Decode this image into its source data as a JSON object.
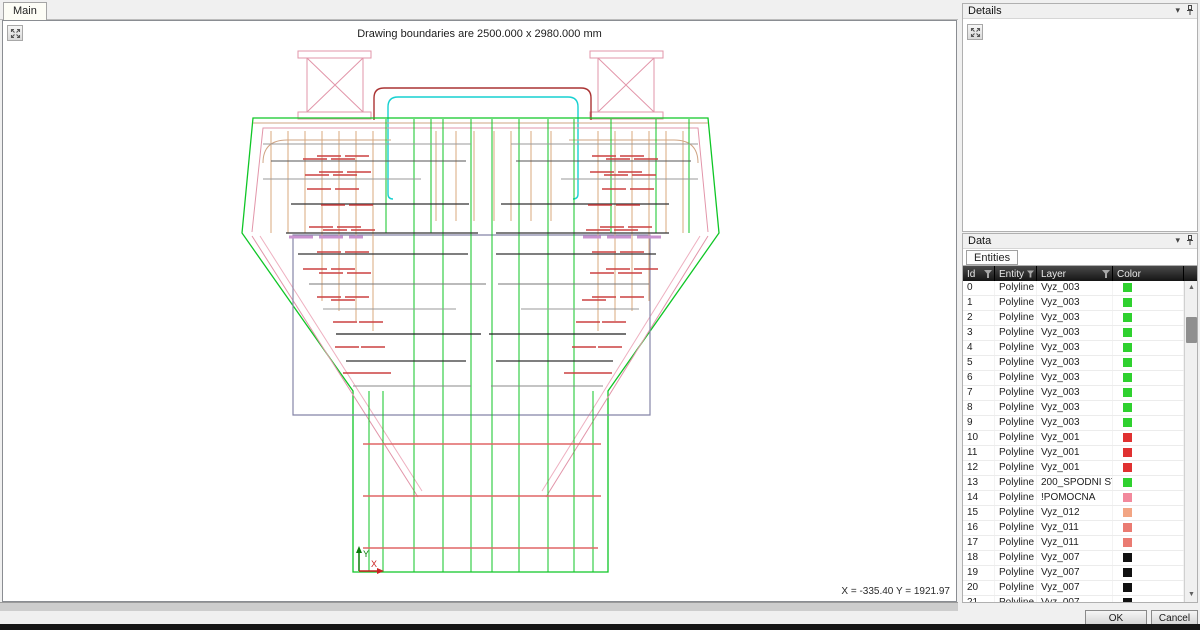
{
  "main_panel": {
    "tab": "Main",
    "canvas_title": "Drawing boundaries are 2500.000 x 2980.000 mm",
    "status_coords": "X = -335.40  Y = 1921.97"
  },
  "details_panel": {
    "title": "Details"
  },
  "data_panel": {
    "title": "Data",
    "tab": "Entities",
    "columns": [
      "Id",
      "Entity",
      "Layer",
      "Color"
    ],
    "rows": [
      {
        "id": "0",
        "entity": "Polyline 2D",
        "layer": "Vyz_003",
        "color": "#2fd12f"
      },
      {
        "id": "1",
        "entity": "Polyline 2D",
        "layer": "Vyz_003",
        "color": "#2fd12f"
      },
      {
        "id": "2",
        "entity": "Polyline 2D",
        "layer": "Vyz_003",
        "color": "#2fd12f"
      },
      {
        "id": "3",
        "entity": "Polyline 2D",
        "layer": "Vyz_003",
        "color": "#2fd12f"
      },
      {
        "id": "4",
        "entity": "Polyline 2D",
        "layer": "Vyz_003",
        "color": "#2fd12f"
      },
      {
        "id": "5",
        "entity": "Polyline 2D",
        "layer": "Vyz_003",
        "color": "#2fd12f"
      },
      {
        "id": "6",
        "entity": "Polyline 2D",
        "layer": "Vyz_003",
        "color": "#2fd12f"
      },
      {
        "id": "7",
        "entity": "Polyline 2D",
        "layer": "Vyz_003",
        "color": "#2fd12f"
      },
      {
        "id": "8",
        "entity": "Polyline 2D",
        "layer": "Vyz_003",
        "color": "#2fd12f"
      },
      {
        "id": "9",
        "entity": "Polyline 2D",
        "layer": "Vyz_003",
        "color": "#2fd12f"
      },
      {
        "id": "10",
        "entity": "Polyline 2D",
        "layer": "Vyz_001",
        "color": "#e03131"
      },
      {
        "id": "11",
        "entity": "Polyline 2D",
        "layer": "Vyz_001",
        "color": "#e03131"
      },
      {
        "id": "12",
        "entity": "Polyline 2D",
        "layer": "Vyz_001",
        "color": "#e03131"
      },
      {
        "id": "13",
        "entity": "Polyline 2D",
        "layer": "200_SPODNI STAVBA",
        "color": "#2fd12f"
      },
      {
        "id": "14",
        "entity": "Polyline 2D",
        "layer": "!POMOCNA",
        "color": "#f2899c"
      },
      {
        "id": "15",
        "entity": "Polyline 2D",
        "layer": "Vyz_012",
        "color": "#f2a584"
      },
      {
        "id": "16",
        "entity": "Polyline 2D",
        "layer": "Vyz_011",
        "color": "#ea7b72"
      },
      {
        "id": "17",
        "entity": "Polyline 2D",
        "layer": "Vyz_011",
        "color": "#ea7b72"
      },
      {
        "id": "18",
        "entity": "Polyline 2D",
        "layer": "Vyz_007",
        "color": "#111111"
      },
      {
        "id": "19",
        "entity": "Polyline 2D",
        "layer": "Vyz_007",
        "color": "#111111"
      },
      {
        "id": "20",
        "entity": "Polyline 2D",
        "layer": "Vyz_007",
        "color": "#111111"
      },
      {
        "id": "21",
        "entity": "Polyline 2D",
        "layer": "Vyz_007",
        "color": "#111111"
      }
    ]
  },
  "footer": {
    "ok_label": "OK",
    "cancel_label": "Cancel"
  },
  "drawing": {
    "tick_len": 24,
    "tick_color": "#cc4040",
    "paths": [
      {
        "d": "M297 50 H370 V57 H297 Z",
        "s": "#e295a9",
        "w": 1
      },
      {
        "d": "M306 57 H362 V111 H306 Z M306 57 L362 111 M362 57 L306 111",
        "s": "#e295a9",
        "w": 1
      },
      {
        "d": "M297 111 H370 V118 H297 Z",
        "s": "#e295a9",
        "w": 1
      },
      {
        "d": "M589 50 H662 V57 H589 Z",
        "s": "#e295a9",
        "w": 1
      },
      {
        "d": "M597 57 H653 V111 H597 Z M597 57 L653 111 M653 57 L597 111",
        "s": "#e295a9",
        "w": 1
      },
      {
        "d": "M589 111 H662 V118 H589 Z",
        "s": "#e295a9",
        "w": 1
      },
      {
        "d": "M373 119 V97 Q373 87 383 87 H580 Q590 87 590 97 V119",
        "s": "#aa3333",
        "w": 1.4
      },
      {
        "d": "M387 193 V106 Q387 96 397 96 H567 Q577 96 577 106 V193",
        "s": "#17d1d1",
        "w": 1.4
      },
      {
        "d": "M387 193 Q387 198 392 198 M577 193 Q577 198 572 198",
        "s": "#17d1d1",
        "w": 1.4
      },
      {
        "d": "M252 117 H707 L718 232 L607 390 V571 H352 V390 L241 232 Z",
        "s": "#0fc626",
        "w": 1.3
      },
      {
        "d": "M251 231 L262 127 H697 L707 231",
        "s": "#e295a9",
        "w": 1
      },
      {
        "d": "M262 127 H697",
        "s": "#e295a9",
        "w": 1
      },
      {
        "d": "M251 235 L417 496 M707 235 L545 496",
        "s": "#e295a9",
        "w": 1
      },
      {
        "d": "M259 235 L421 490 M699 235 L541 490",
        "s": "#eeb0c0",
        "w": 1
      },
      {
        "d": "M252 122 H707",
        "s": "#cfa483",
        "w": 1
      },
      {
        "d": "M262 162 Q262 139 286 139 H390 M697 162 Q697 139 673 139 H568",
        "s": "#cfa483",
        "w": 1
      },
      {
        "d": "M292 234 H649 V414 H292 Z",
        "s": "#8585a8",
        "w": 1.2
      },
      {
        "d": "M413 118 V571 M442 118 V571 M470 118 V571 M491 118 V571 M518 118 V571 M547 118 V571 M573 118 V571",
        "s": "#0fc626",
        "w": 1
      },
      {
        "d": "M385 118 V232 M430 118 V232 M610 118 V232 M655 118 V232 M688 118 V232",
        "s": "#0fc626",
        "w": 1
      },
      {
        "d": "M368 390 V571 M382 390 V571 M592 390 V571",
        "s": "#0fc626",
        "w": 1
      },
      {
        "d": "M270 130 V232 M287 130 V232 M304 130 V232 M321 130 V300 M338 130 V310 M355 130 V320 M372 130 V330",
        "s": "#d9a87e",
        "w": 1
      },
      {
        "d": "M597 130 V330 M614 130 V320 M631 130 V310 M648 130 V300 M665 130 V232 M682 130 V232",
        "s": "#d9a87e",
        "w": 1
      },
      {
        "d": "M435 130 V220 M455 130 V220 M473 130 V220 M493 130 V220 M510 130 V220 M530 130 V220 M550 130 V220",
        "s": "#d9a87e",
        "w": 1
      },
      {
        "d": "M262 143 H470 M510 143 H697",
        "s": "#999999",
        "w": 1
      },
      {
        "d": "M270 160 H465 M515 160 H690",
        "s": "#555555",
        "w": 1
      },
      {
        "d": "M262 178 H420 M560 178 H697",
        "s": "#999999",
        "w": 1
      },
      {
        "d": "M290 203 H468 M500 203 H668",
        "s": "#333333",
        "w": 1.2
      },
      {
        "d": "M285 232 H477 M495 232 H668",
        "s": "#333333",
        "w": 1.2
      },
      {
        "d": "M297 253 H467 M495 253 H655",
        "s": "#333333",
        "w": 1.2
      },
      {
        "d": "M308 283 H485 M497 283 H648",
        "s": "#777777",
        "w": 1
      },
      {
        "d": "M322 308 H455 M520 308 H638",
        "s": "#999999",
        "w": 1
      },
      {
        "d": "M335 333 H480 M488 333 H625",
        "s": "#222222",
        "w": 1.3
      },
      {
        "d": "M345 360 H465 M495 360 H612",
        "s": "#333333",
        "w": 1.2
      },
      {
        "d": "M352 385 H470 M490 385 H602",
        "s": "#888888",
        "w": 1
      },
      {
        "d": "M362 443 H600 M362 495 H600 M362 547 H597",
        "s": "#e06666",
        "w": 1.4
      },
      {
        "d": "M288 236 H312 M318 236 H342 M348 236 H362 M582 236 H600 M606 236 H630 M636 236 H660",
        "s": "#c993cf",
        "w": 3
      },
      {
        "d": "M358 570 V549",
        "s": "#0a7a0a",
        "w": 1.5
      },
      {
        "d": "M355 552 L358 545 L361 552 Z",
        "s": "none",
        "f": "#0a7a0a"
      },
      {
        "d": "M358 570 H379",
        "s": "#cc2222",
        "w": 1.5
      },
      {
        "d": "M376 567 L383 570 L376 573 Z",
        "s": "none",
        "f": "#cc2222"
      }
    ],
    "tick_rows": [
      {
        "y": 155,
        "L": [
          316,
          344
        ],
        "R": [
          591,
          619
        ]
      },
      {
        "y": 158,
        "L": [
          302,
          330
        ],
        "R": [
          605,
          633
        ]
      },
      {
        "y": 171,
        "L": [
          318,
          346
        ],
        "R": [
          589,
          617
        ]
      },
      {
        "y": 174,
        "L": [
          304,
          332
        ],
        "R": [
          603,
          631
        ]
      },
      {
        "y": 188,
        "L": [
          306,
          334
        ],
        "R": [
          601,
          629
        ]
      },
      {
        "y": 204,
        "L": [
          320,
          348
        ],
        "R": [
          587,
          615
        ]
      },
      {
        "y": 226,
        "L": [
          308,
          336
        ],
        "R": [
          599,
          627
        ]
      },
      {
        "y": 229,
        "L": [
          322,
          350
        ],
        "R": [
          585,
          613
        ]
      },
      {
        "y": 251,
        "L": [
          316,
          344
        ],
        "R": [
          591,
          619
        ]
      },
      {
        "y": 268,
        "L": [
          302,
          330
        ],
        "R": [
          605,
          633
        ]
      },
      {
        "y": 272,
        "L": [
          318,
          346
        ],
        "R": [
          589,
          617
        ]
      },
      {
        "y": 296,
        "L": [
          316,
          344
        ],
        "R": [
          591,
          619
        ]
      },
      {
        "y": 299,
        "L": [
          330
        ],
        "R": [
          581
        ]
      },
      {
        "y": 321,
        "L": [
          332,
          358
        ],
        "R": [
          575,
          601
        ]
      },
      {
        "y": 346,
        "L": [
          334,
          360
        ],
        "R": [
          571,
          597
        ]
      },
      {
        "y": 372,
        "L": [
          342,
          366
        ],
        "R": [
          563,
          587
        ]
      }
    ],
    "texts": [
      {
        "x": 362,
        "y": 556,
        "t": "Y",
        "c": "#0a7a0a"
      },
      {
        "x": 370,
        "y": 566,
        "t": "X",
        "c": "#cc2222"
      }
    ]
  }
}
